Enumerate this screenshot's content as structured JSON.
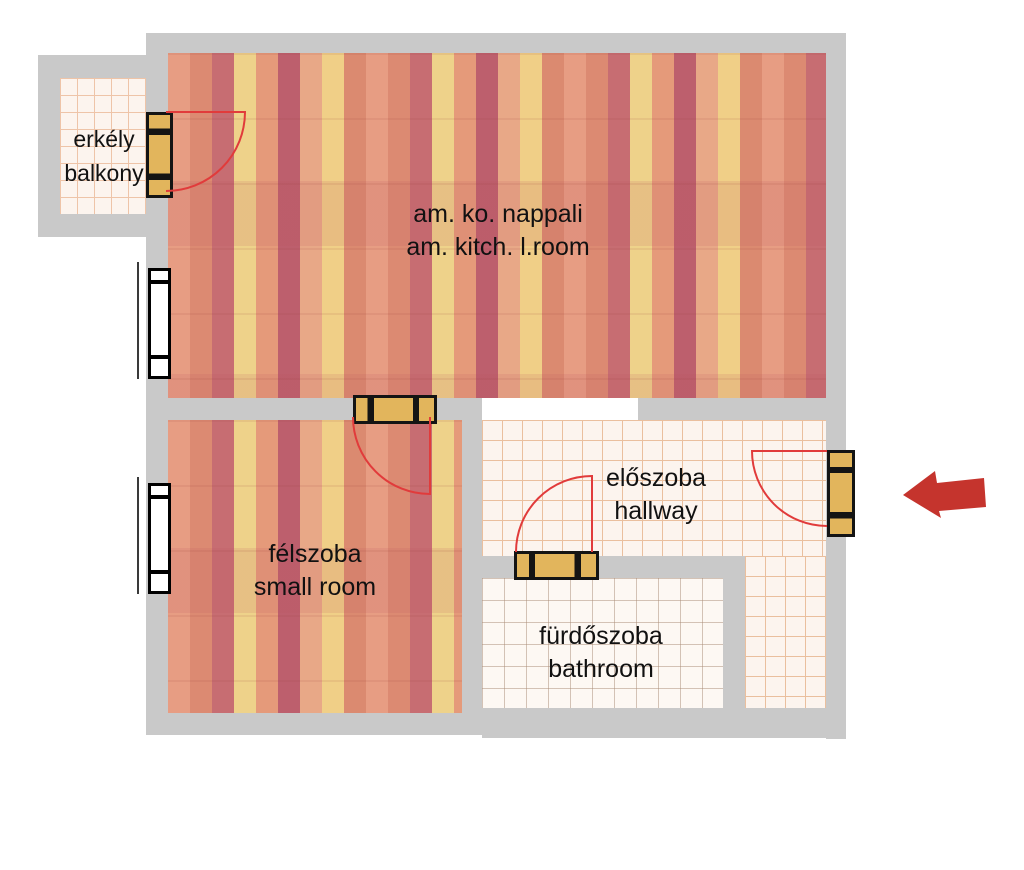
{
  "floorplan": {
    "rooms": {
      "balcony": {
        "label_hu": "erkély",
        "label_en": "balkony"
      },
      "living": {
        "label_hu": "am. ko. nappali",
        "label_en": "am. kitch. l.room"
      },
      "small_room": {
        "label_hu": "félszoba",
        "label_en": "small room"
      },
      "hallway": {
        "label_hu": "előszoba",
        "label_en": "hallway"
      },
      "bathroom": {
        "label_hu": "fürdőszoba",
        "label_en": "bathroom"
      }
    },
    "colors": {
      "wall": "#c9c9c9",
      "wood_floor_base": "#e39a7e",
      "tile_background": "#fcf4ee",
      "tile_grid_line": "#eabf9e",
      "door_fill": "#e2b55c",
      "door_frame": "#141414",
      "swing_arc": "#e13b3b",
      "entrance_arrow": "#c5342d",
      "text": "#111111"
    },
    "icons": {
      "doors": [
        "balcony-door-icon",
        "room-door-icon",
        "bathroom-door-icon",
        "entrance-door-icon"
      ],
      "windows": [
        "living-window-icon",
        "small-room-window-icon"
      ],
      "arrow": "entrance-arrow-left-icon"
    }
  }
}
